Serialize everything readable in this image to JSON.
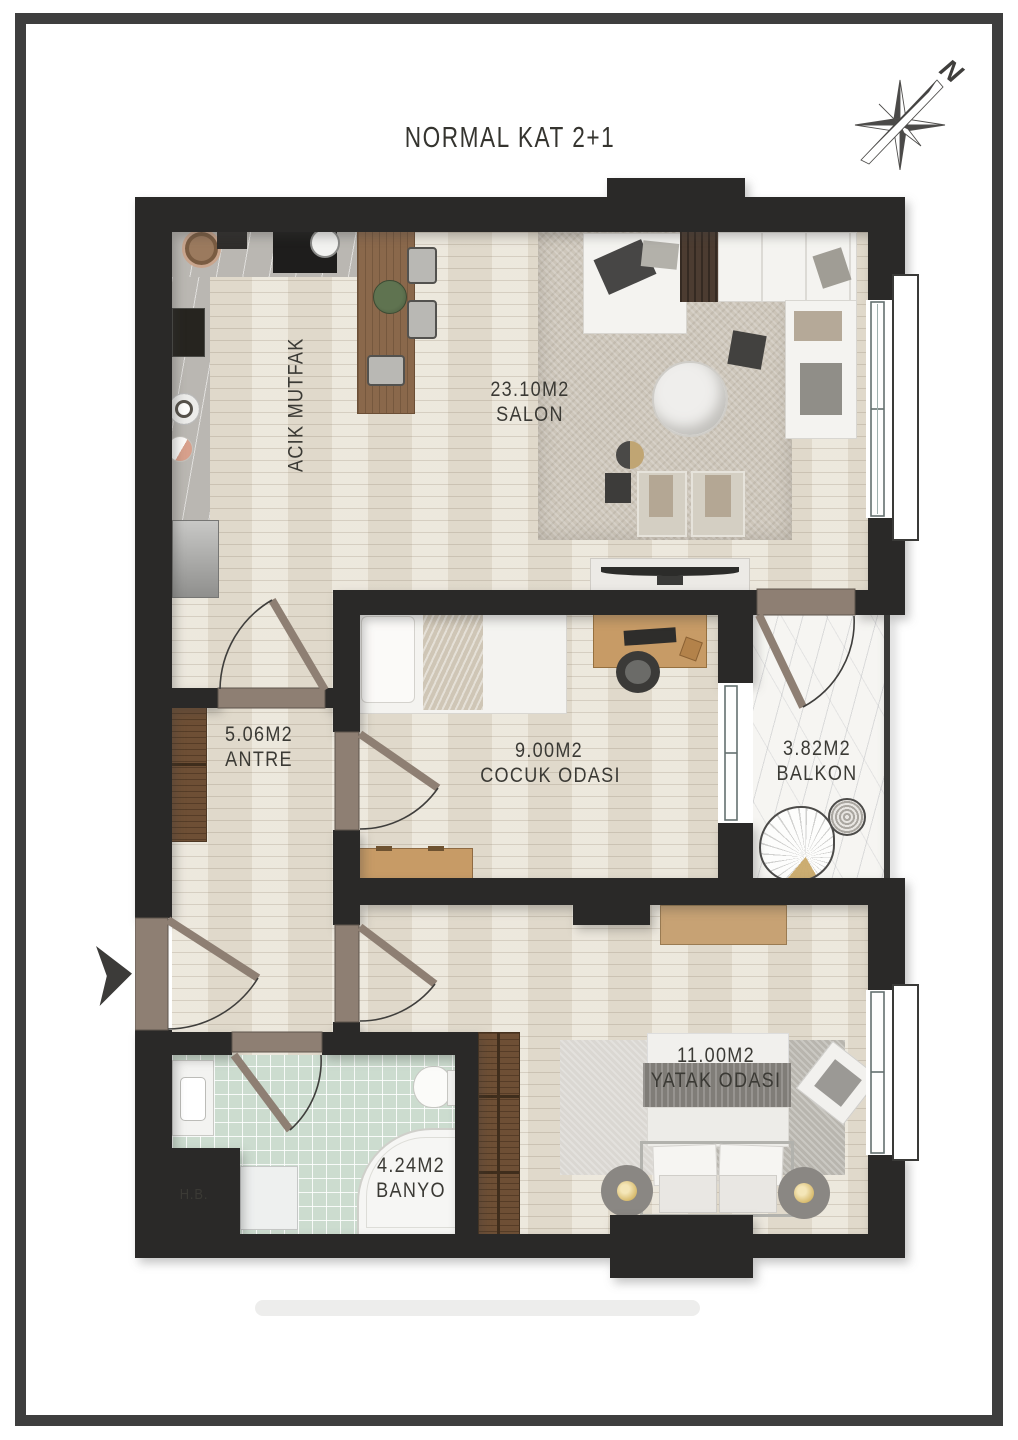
{
  "title": "NORMAL KAT 2+1",
  "compass": {
    "north_label": "N"
  },
  "rooms": {
    "kitchen": {
      "name": "ACIK MUTFAK"
    },
    "salon": {
      "area": "23.10M2",
      "name": "SALON"
    },
    "antre": {
      "area": "5.06M2",
      "name": "ANTRE"
    },
    "cocuk": {
      "area": "9.00M2",
      "name": "COCUK ODASI"
    },
    "balkon": {
      "area": "3.82M2",
      "name": "BALKON"
    },
    "banyo": {
      "area": "4.24M2",
      "name": "BANYO"
    },
    "yatak": {
      "area": "11.00M2",
      "name": "YATAK ODASI"
    },
    "shaft": {
      "name": "H.B."
    }
  }
}
